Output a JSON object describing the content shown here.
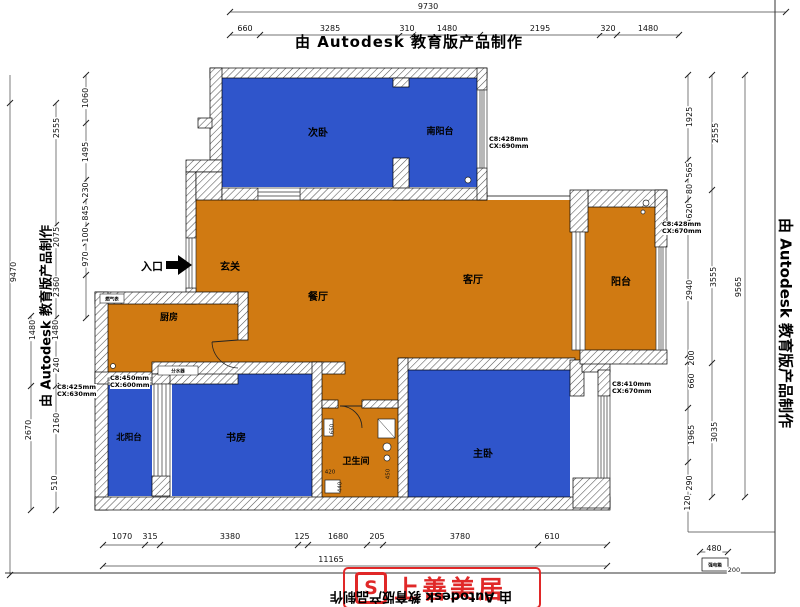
{
  "watermark": {
    "text": "由 Autodesk 教育版产品制作"
  },
  "logo": {
    "name": "上善美居",
    "mark": "S"
  },
  "entrance": {
    "label": "入口"
  },
  "rooms": {
    "second_bedroom": "次卧",
    "south_balcony": "南阳台",
    "hallway": "玄关",
    "dining": "餐厅",
    "living": "客厅",
    "balcony": "阳台",
    "kitchen": "厨房",
    "north_balcony": "北阳台",
    "study": "书房",
    "bathroom": "卫生间",
    "master_bedroom": "主卧"
  },
  "fixtures": {
    "gas_meter": "燃气表",
    "manifold": "分水器",
    "power_box": "强电箱"
  },
  "notes": {
    "top_right": [
      "C8:428mm",
      "CX:690mm"
    ],
    "balcony_right": [
      "C8:428mm",
      "CX:670mm"
    ],
    "master_right": [
      "C8:410mm",
      "CX:670mm"
    ],
    "left_margin": [
      "C8:425mm",
      "CX:630mm"
    ],
    "north_balcony": [
      "C8:450mm",
      "CX:600mm"
    ]
  },
  "dims": {
    "top_total": "9730",
    "top": [
      "660",
      "3285",
      "310",
      "1480",
      "2195",
      "320",
      "1480"
    ],
    "left": [
      "9470",
      "2555",
      "2075",
      "2360",
      "1480",
      "2670",
      "1060",
      "1495",
      "230",
      "845",
      "100",
      "970",
      "1480",
      "240",
      "2160",
      "510"
    ],
    "right": [
      "1925",
      "565",
      "80",
      "620",
      "2940",
      "200",
      "660",
      "1965",
      "290",
      "120",
      "2555",
      "3555",
      "3035",
      "9565"
    ],
    "bottom": [
      "1070",
      "315",
      "3380",
      "125",
      "1680",
      "205",
      "3780",
      "610"
    ],
    "bottom_total": "11165",
    "meter_width": "480",
    "meter_side": "200",
    "bath": [
      "650",
      "420",
      "440",
      "450"
    ]
  },
  "colors": {
    "room_blue": "#2f55cb",
    "room_orange": "#d07a12",
    "brand_red": "#e02828"
  }
}
